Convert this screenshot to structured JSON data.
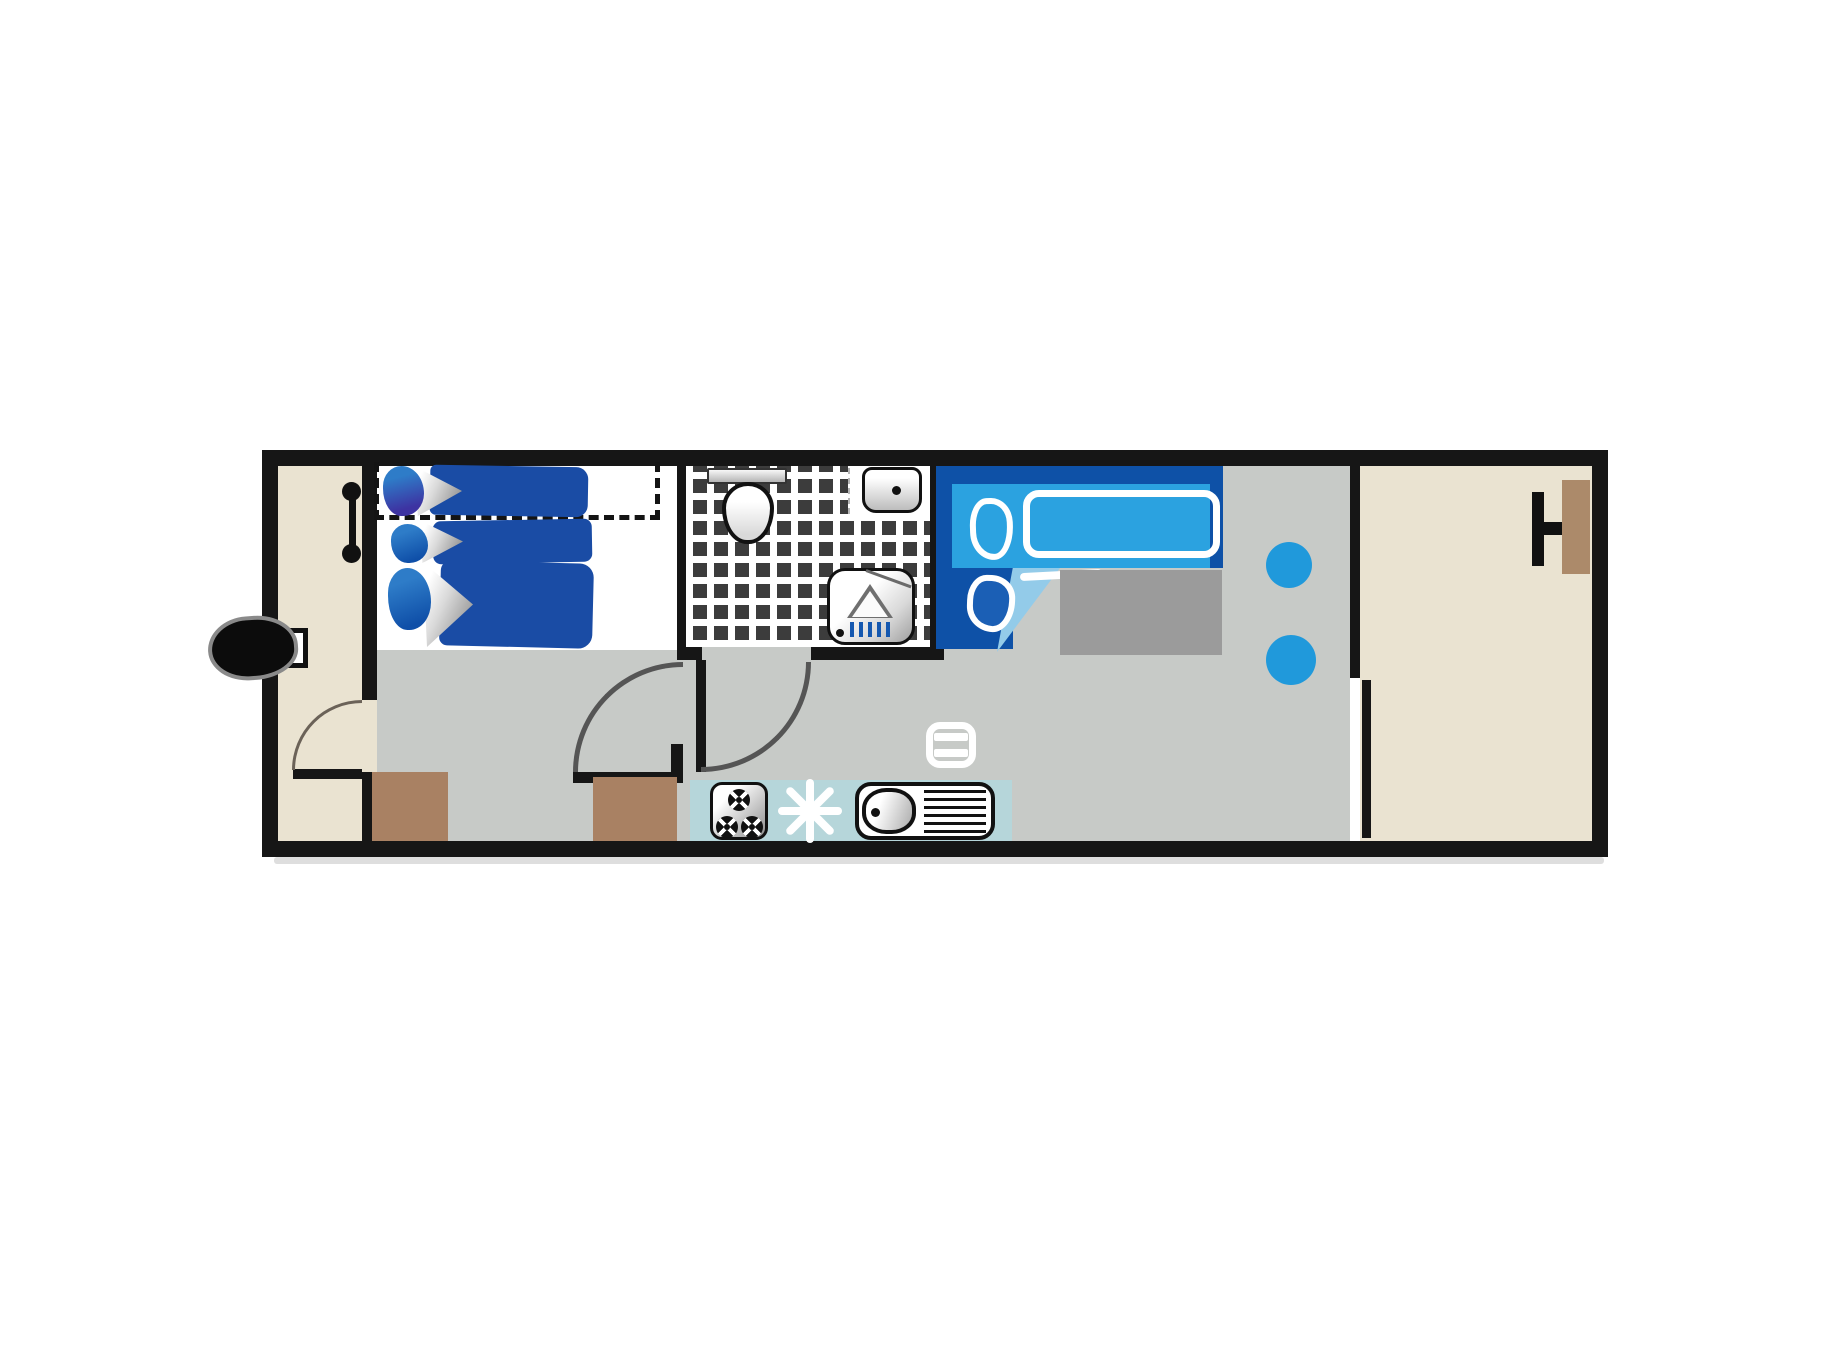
{
  "title": "",
  "colors": {
    "wall": "#161616",
    "beige": "#EAE3D1",
    "gray": "#C7CAC7",
    "navy": "#0E51A7",
    "blue": "#2BA2E0",
    "teal": "#B6D6DA",
    "brown": "#A98163",
    "tile": "#3C3C3C",
    "accent": "#2099DB",
    "quilt": "#1A4CA5",
    "grayblock": "#9B9B9B"
  },
  "floor_plan": {
    "type": "mobile-home",
    "rooms": [
      {
        "id": "entrance-hall",
        "floor": "beige"
      },
      {
        "id": "kids-bedroom",
        "floor": "white-and-gray",
        "beds": 3,
        "bunk_overhead_dashed": true
      },
      {
        "id": "bathroom",
        "floor": "dark-tile-checker",
        "fixtures": [
          "toilet",
          "washbasin",
          "shower"
        ]
      },
      {
        "id": "living-kitchen",
        "floor": "gray",
        "items": [
          "double-bed",
          "side-block",
          "stool",
          "stool",
          "table-icon",
          "hob",
          "fridge-snowflake",
          "sink",
          "cabinet"
        ]
      },
      {
        "id": "terrace",
        "floor": "beige",
        "items": [
          "table-with-bench"
        ]
      }
    ],
    "doors": [
      {
        "id": "hall-door",
        "swing": "into-hall"
      },
      {
        "id": "bedroom-door",
        "swing": "into-bedroom"
      },
      {
        "id": "bathroom-door",
        "swing": "into-corridor"
      },
      {
        "id": "terrace-sliding-door",
        "type": "sliding"
      }
    ],
    "exterior": [
      "entry-step"
    ]
  }
}
